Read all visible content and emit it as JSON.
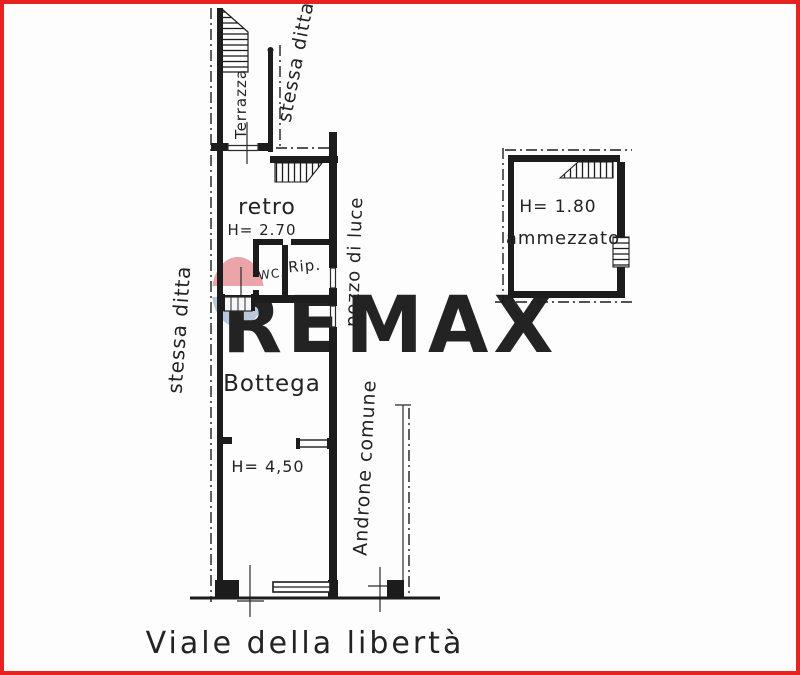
{
  "page": {
    "background": "#fdfdfd",
    "frame_color": "#e8231f",
    "ink_color": "#1c1c1c"
  },
  "watermark": {
    "brand": "REMAX",
    "text_color": "#d2d2d2",
    "balloon_red": "#eba4a8",
    "balloon_white": "#ffffff",
    "balloon_blue": "#b9c8dc"
  },
  "plan": {
    "labels": {
      "terrazza": "Terrazza",
      "stessa_ditta_top": "stessa ditta",
      "stessa_ditta_left": "stessa ditta",
      "retro": "retro",
      "retro_height": "H= 2.70",
      "wc": "WC.",
      "rip": "Rip.",
      "pozzo_di_luce": "pozzo di luce",
      "bottega": "Bottega",
      "bottega_height": "H= 4,50",
      "androne": "Androne comune",
      "ammezzato_height": "H= 1.80",
      "ammezzato": "ammezzato",
      "street": "Viale della libertà"
    }
  }
}
